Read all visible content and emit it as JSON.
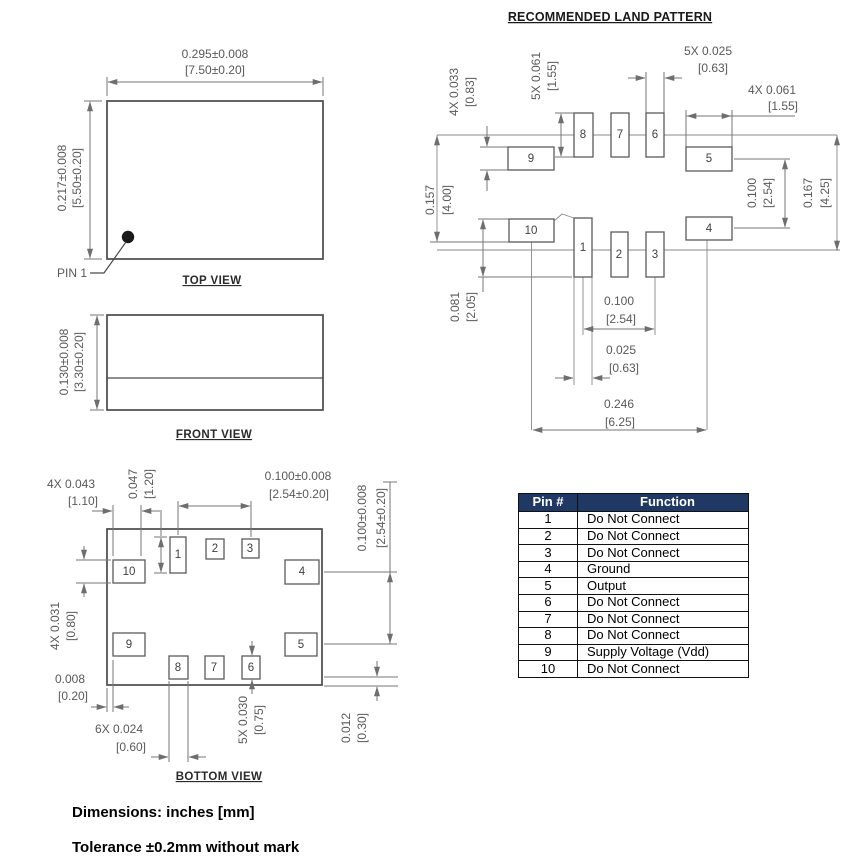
{
  "top_view": {
    "label": "TOP VIEW",
    "pin1_label": "PIN 1",
    "width_in": "0.295±0.008",
    "width_mm": "[7.50±0.20]",
    "height_in": "0.217±0.008",
    "height_mm": "[5.50±0.20]"
  },
  "front_view": {
    "label": "FRONT VIEW",
    "height_in": "0.130±0.008",
    "height_mm": "[3.30±0.20]"
  },
  "bottom_view": {
    "label": "BOTTOM VIEW",
    "pads": {
      "p1": "1",
      "p2": "2",
      "p3": "3",
      "p4": "4",
      "p5": "5",
      "p6": "6",
      "p7": "7",
      "p8": "8",
      "p9": "9",
      "p10": "10"
    },
    "dims": {
      "corner_pad_width_in": "4X 0.043",
      "corner_pad_width_mm": "[1.10]",
      "pad1_height_in": "0.047",
      "pad1_height_mm": "[1.20]",
      "pitch_top_in": "0.100±0.008",
      "pitch_top_mm": "[2.54±0.20]",
      "pitch_right_in": "0.100±0.008",
      "pitch_right_mm": "[2.54±0.20]",
      "corner_pad_height_in": "4X 0.031",
      "corner_pad_height_mm": "[0.80]",
      "edge_gap_in": "0.008",
      "edge_gap_mm": "[0.20]",
      "small_pad_width_in": "6X 0.024",
      "small_pad_width_mm": "[0.60]",
      "small_pad_height_in": "5X 0.030",
      "small_pad_height_mm": "[0.75]",
      "bottom_gap_in": "0.012",
      "bottom_gap_mm": "[0.30]"
    }
  },
  "land_pattern": {
    "title": "RECOMMENDED LAND PATTERN",
    "pads": {
      "p1": "1",
      "p2": "2",
      "p3": "3",
      "p4": "4",
      "p5": "5",
      "p6": "6",
      "p7": "7",
      "p8": "8",
      "p9": "9",
      "p10": "10"
    },
    "dims": {
      "horiz_pad_height_in": "4X 0.033",
      "horiz_pad_height_mm": "[0.83]",
      "vert_pad_height_in": "5X 0.061",
      "vert_pad_height_mm": "[1.55]",
      "vert_pad_width_in": "5X 0.025",
      "vert_pad_width_mm": "[0.63]",
      "horiz_pad_width_in": "4X 0.061",
      "horiz_pad_width_mm": "[1.55]",
      "left_span_in": "0.157",
      "left_span_mm": "[4.00]",
      "right_pitch_in": "0.100",
      "right_pitch_mm": "[2.54]",
      "right_span_in": "0.167",
      "right_span_mm": "[4.25]",
      "pad1_height_in": "0.081",
      "pad1_height_mm": "[2.05]",
      "bottom_pitch_in": "0.100",
      "bottom_pitch_mm": "[2.54]",
      "pad1_width_in": "0.025",
      "pad1_width_mm": "[0.63]",
      "row_width_in": "0.246",
      "row_width_mm": "[6.25]"
    }
  },
  "pin_table": {
    "header_pin": "Pin #",
    "header_function": "Function",
    "rows": [
      {
        "pin": "1",
        "fn": "Do Not Connect"
      },
      {
        "pin": "2",
        "fn": "Do Not Connect"
      },
      {
        "pin": "3",
        "fn": "Do Not Connect"
      },
      {
        "pin": "4",
        "fn": "Ground"
      },
      {
        "pin": "5",
        "fn": "Output"
      },
      {
        "pin": "6",
        "fn": "Do Not Connect"
      },
      {
        "pin": "7",
        "fn": "Do Not Connect"
      },
      {
        "pin": "8",
        "fn": "Do Not Connect"
      },
      {
        "pin": "9",
        "fn": "Supply Voltage (Vdd)"
      },
      {
        "pin": "10",
        "fn": "Do Not Connect"
      }
    ]
  },
  "notes": {
    "units": "Dimensions: inches [mm]",
    "tolerance": "Tolerance ±0.2mm without mark"
  },
  "colors": {
    "table_header_bg": "#1f3864",
    "drawing_line": "#6e6e6e"
  }
}
